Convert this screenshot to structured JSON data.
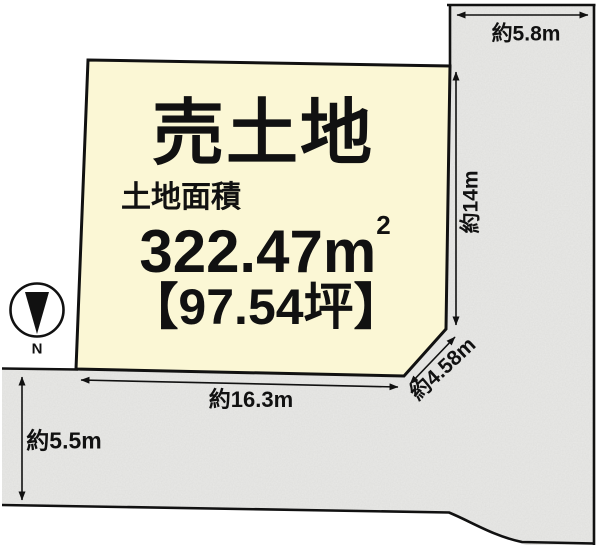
{
  "diagram": {
    "plot": {
      "title": "売土地",
      "area_label": "土地面積",
      "area_value": "322.47m",
      "area_superscript": "2",
      "tsubo_value": "【97.54坪】"
    },
    "dimensions": {
      "top_road_width": "約5.8m",
      "right_frontage": "約14m",
      "corner_cut": "約4.58m",
      "bottom_frontage": "約16.3m",
      "left_road_width": "約5.5m"
    },
    "compass": {
      "north_label": "N"
    },
    "colors": {
      "plot_fill": "#FBF7D5",
      "road_fill": "#E9E9E7",
      "line": "#111111"
    }
  }
}
